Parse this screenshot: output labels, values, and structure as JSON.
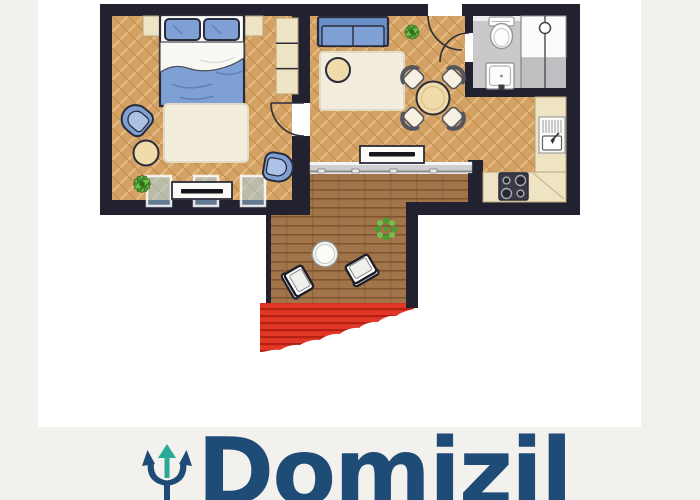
{
  "brand": {
    "name": "Domizil",
    "logo_text_color": "#1f4b77",
    "logo_accent_color": "#2aa898"
  },
  "palette": {
    "bg": "#f2f1ed",
    "canvas": "#ffffff",
    "wall": "#212130",
    "outline": "#2b2b3c",
    "parquet": "#d4a264",
    "parquet-light": "#e4b87e",
    "parquet-dark": "#b78746",
    "deck": "#a1744a",
    "deck-line": "#7e5530",
    "stairs": "#e23626",
    "stairs-dark": "#b01f12",
    "blue": "#7fa0d4",
    "blue-dark": "#6a8fc4",
    "blue-light": "#a9c2e6",
    "beige": "#eee3c3",
    "beige-edge": "#b9a578",
    "cream": "#f3eddd",
    "bath-gray": "#c9c9cb",
    "green": "#4a9e2f",
    "green-light": "#6fc04b",
    "window-blue": "rgba(166,214,240,0.5)",
    "navy": "#1f4b77",
    "teal": "#2aa898"
  },
  "floor_plan": {
    "type": "apartment-floor-plan",
    "rooms": [
      "bedroom",
      "living-room",
      "kitchen",
      "bathroom",
      "hallway",
      "terrace"
    ]
  }
}
